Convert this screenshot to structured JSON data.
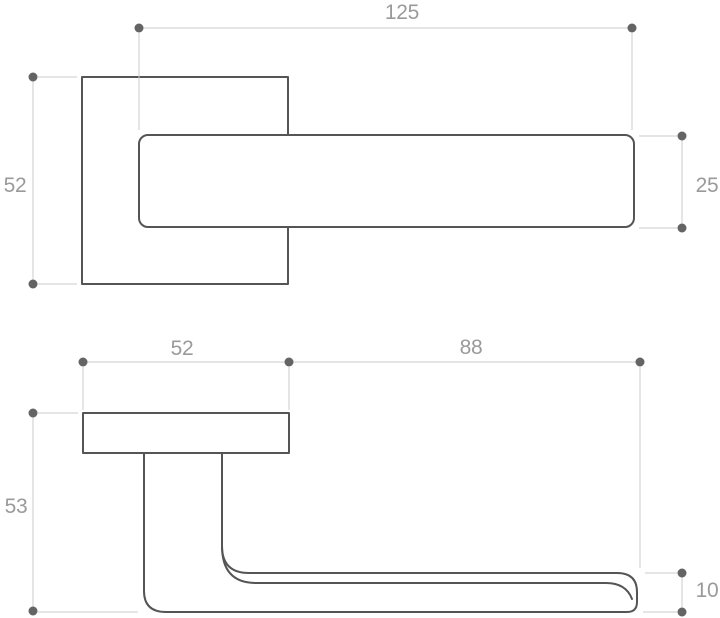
{
  "drawing": {
    "type": "technical-dimension-drawing",
    "subject": "door-lever-handle-on-square-rose",
    "colors": {
      "background": "#ffffff",
      "outline": "#555555",
      "dimension_line": "#cbcbcb",
      "dimension_dot": "#646464",
      "dimension_text": "#9a9a9a"
    },
    "views": {
      "front": {
        "name": "front-view",
        "parts": [
          "square-rose",
          "lever-bar"
        ],
        "dimensions": {
          "lever_length": "125",
          "rose_size": "52",
          "lever_height": "25"
        }
      },
      "side": {
        "name": "side-view",
        "parts": [
          "rose-plate",
          "neck",
          "lever-arm"
        ],
        "dimensions": {
          "rose_width": "52",
          "lever_reach": "88",
          "projection": "53",
          "lever_thickness": "10"
        }
      }
    }
  }
}
